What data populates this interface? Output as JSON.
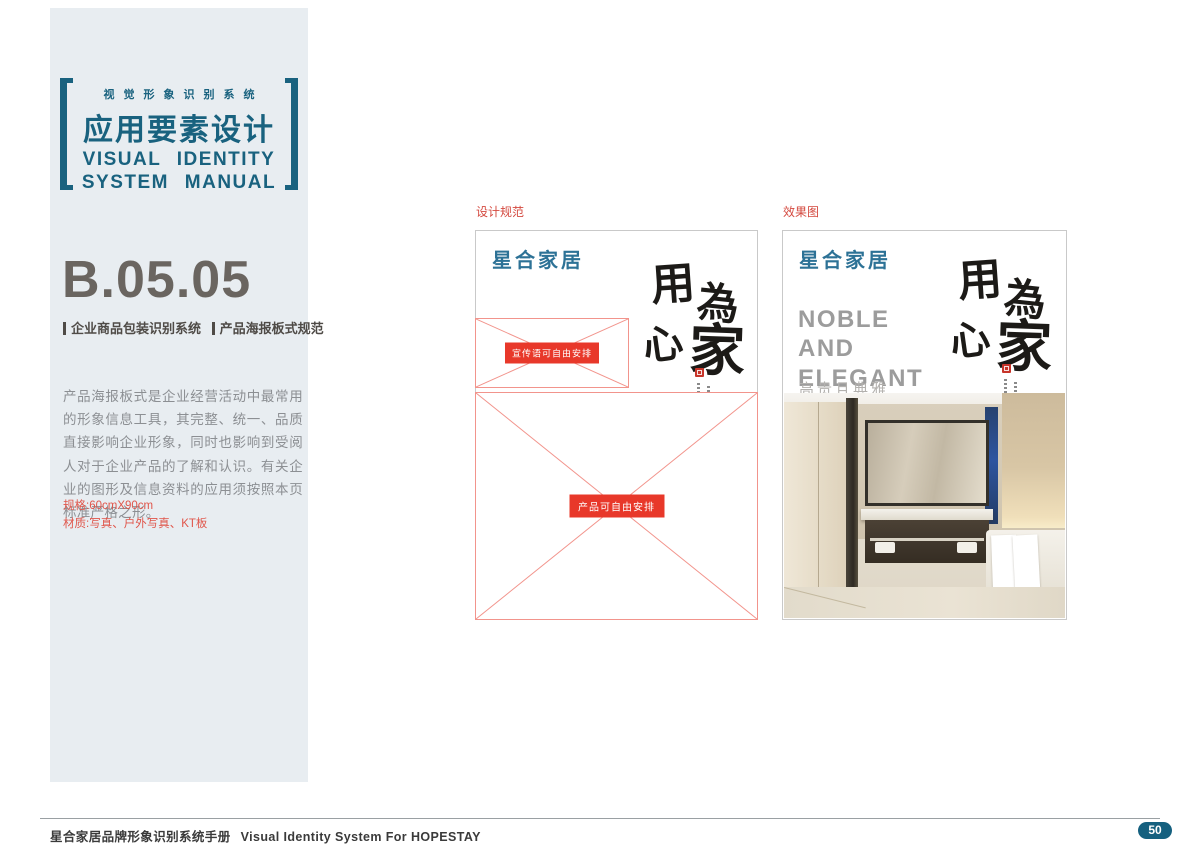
{
  "sidebar": {
    "header": {
      "subtitle_cn": "视觉形象识别系统",
      "title_cn": "应用要素设计",
      "title_en_line1": "VISUAL IDENTITY",
      "title_en_line2": "SYSTEM MANUAL"
    },
    "section": {
      "code": "B.05.05",
      "category": "企业商品包装识别系统",
      "subcategory": "产品海报板式规范"
    },
    "description": "产品海报板式是企业经营活动中最常用的形象信息工具，其完整、统一、品质直接影响企业形象，同时也影响到受阅人对于企业产品的了解和认识。有关企业的图形及信息资料的应用须按照本页标准严格之形。",
    "specs": {
      "size_label": "规格:60cmX90cm",
      "material_label": "材质:写真、户外写真、KT板"
    }
  },
  "main": {
    "design_panel": {
      "label": "设计规范",
      "logo": "星合家居",
      "slogan_box_label": "宣传语可自由安排",
      "product_box_label": "产品可自由安排",
      "calligraphy_chars": [
        "用",
        "心",
        "為",
        "家"
      ]
    },
    "effect_panel": {
      "label": "效果图",
      "logo": "星合家居",
      "headline_lines": [
        "NOBLE",
        "AND",
        "ELEGANT"
      ],
      "subheadline": "高贵且典雅",
      "calligraphy_chars": [
        "用",
        "心",
        "為",
        "家"
      ]
    }
  },
  "footer": {
    "text_cn": "星合家居品牌形象识别系统手册",
    "text_en": "Visual Identity System For HOPESTAY",
    "page_number": "50"
  },
  "colors": {
    "accent_teal": "#19627f",
    "logo_blue": "#2d7296",
    "sidebar_bg": "#e8edf1",
    "placeholder_red": "#e8382a",
    "placeholder_border": "#f2948c",
    "label_red": "#d4493f",
    "spec_red": "#e0554a",
    "code_gray": "#6a6560",
    "headline_gray": "#9c9c9c",
    "badge_teal": "#15607f"
  }
}
